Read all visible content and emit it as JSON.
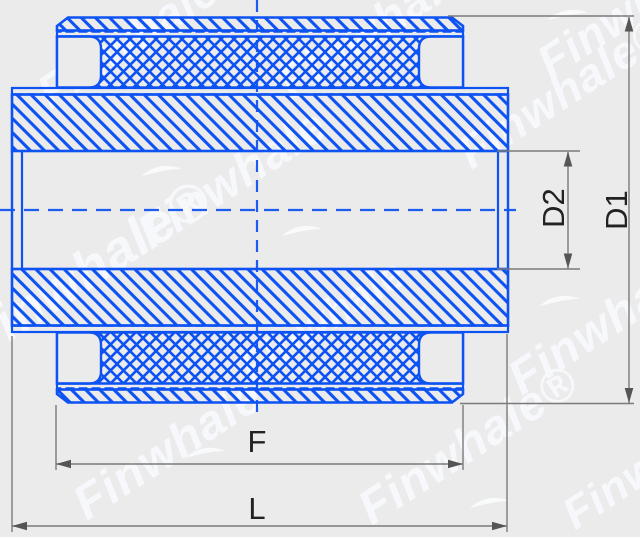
{
  "dimensions": {
    "outer_diameter": {
      "label": "D1"
    },
    "inner_diameter": {
      "label": "D2"
    },
    "flange_length": {
      "label": "F"
    },
    "overall_length": {
      "label": "L"
    }
  },
  "watermark": {
    "brand": "Finwhale",
    "brand_registered": "Finwhale®",
    "registered_mark": "®"
  },
  "colors": {
    "line_blue": "#0d52f2",
    "dimension_gray": "#7a7a7a",
    "arrow_gray": "#555555",
    "label_dark": "#222222",
    "background": "#ebebeb",
    "watermark_white": "#f7f8fb"
  }
}
